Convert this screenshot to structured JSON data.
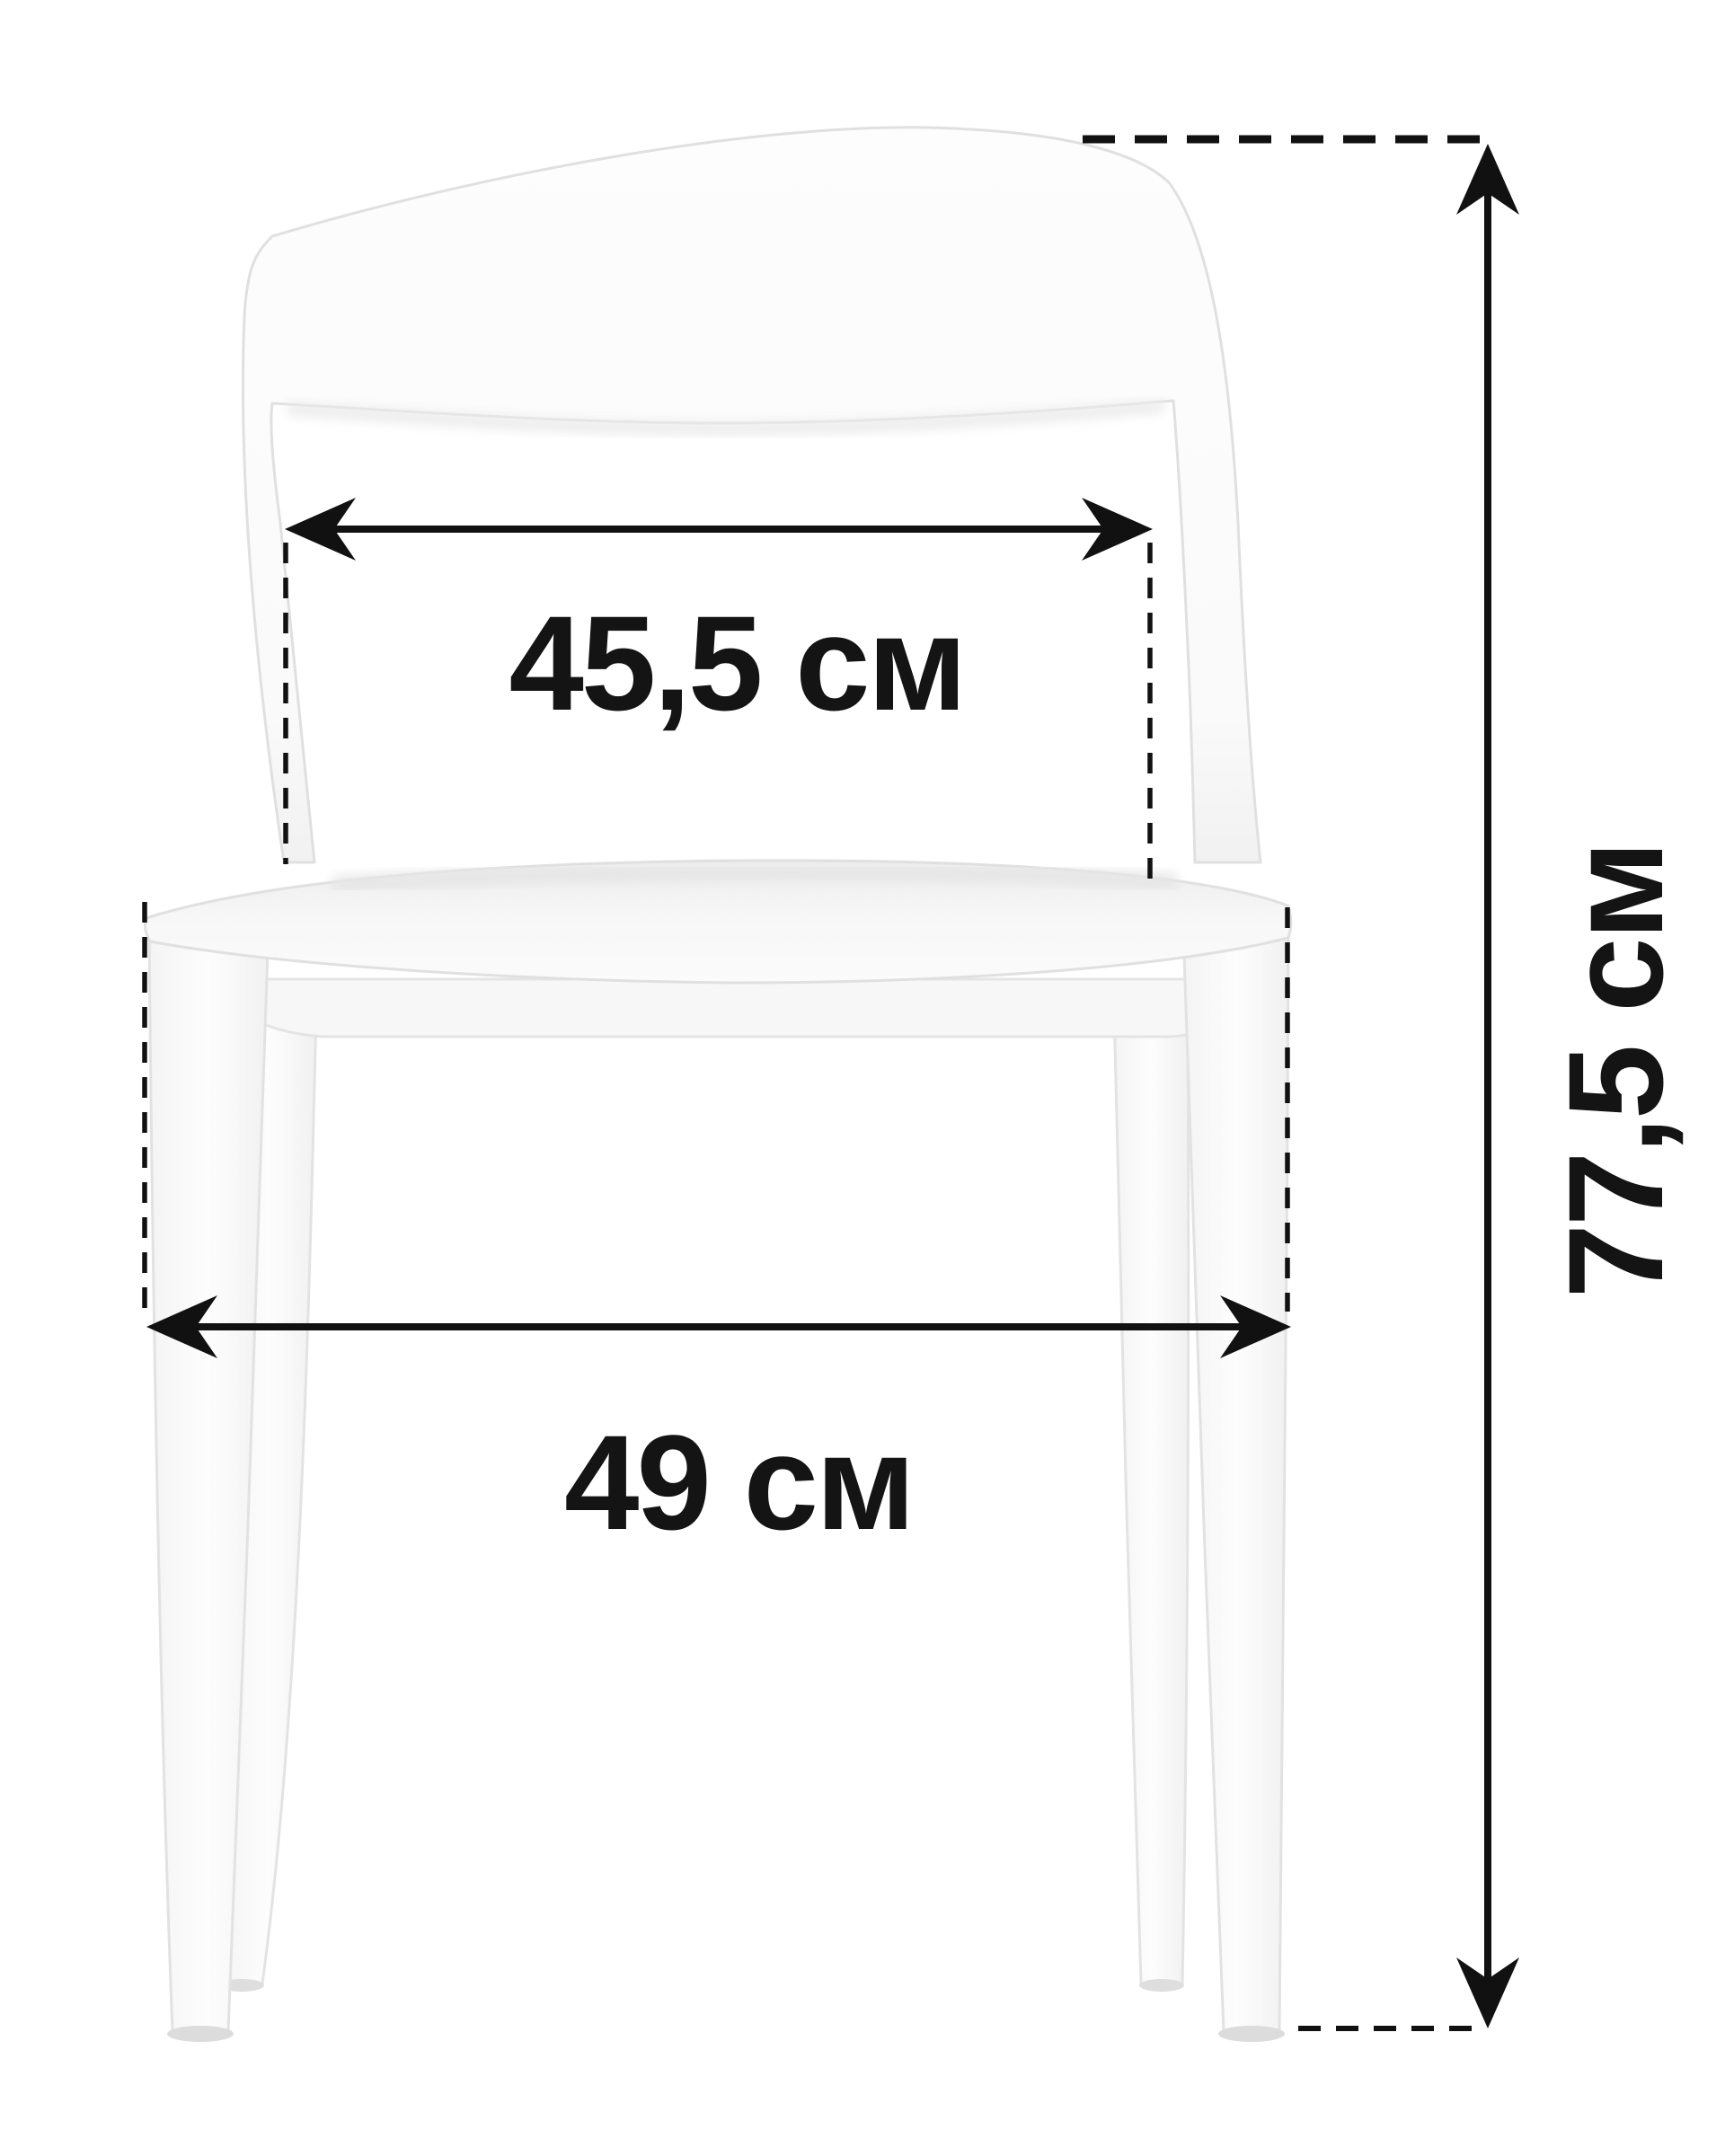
{
  "page": {
    "background": "#ffffff"
  },
  "figure": {
    "subject": "chair-front-view",
    "chair_fill": "#fcfcfc",
    "chair_stroke": "#e0e0e0",
    "annotation_color": "#111111"
  },
  "dimensions": {
    "seat_width": {
      "label": "45,5 см"
    },
    "overall_width": {
      "label": "49 см"
    },
    "overall_height": {
      "label": "77,5 см"
    }
  }
}
